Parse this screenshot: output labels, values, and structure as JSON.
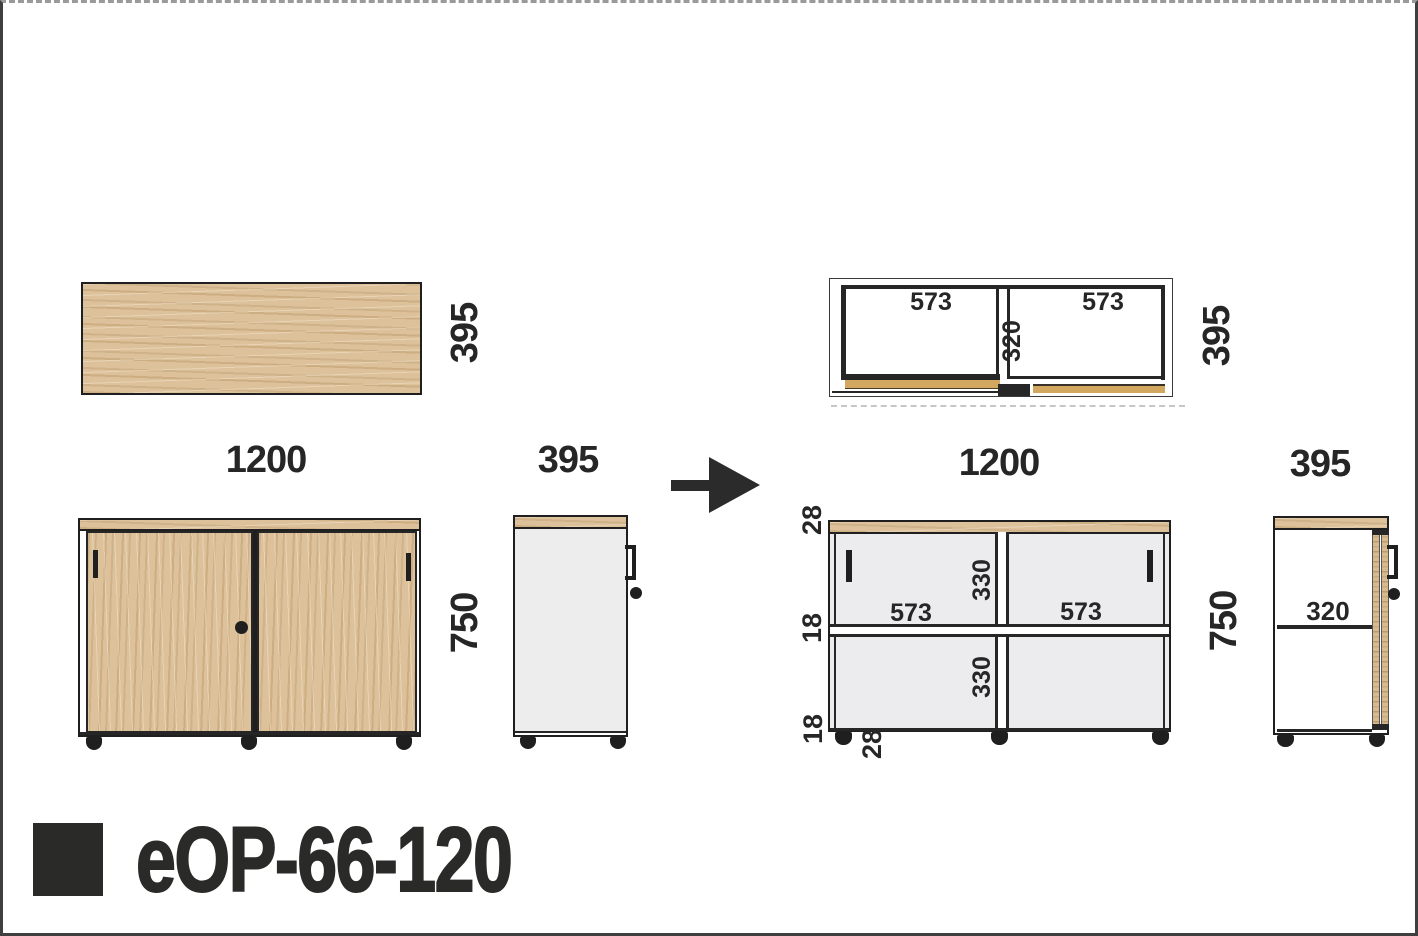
{
  "product": {
    "code": "eOP-66-120"
  },
  "labels": {
    "top_view_depth": "395",
    "top_view_width": "1200",
    "front_view_height": "750",
    "side_view_depth": "395",
    "plan_left_width": "573",
    "plan_right_width": "573",
    "plan_mid_depth": "320",
    "plan_depth": "395",
    "section_width": "1200",
    "section_top_thickness": "28",
    "section_shelf_thickness": "18",
    "section_bottom_thickness": "18",
    "section_plinth_height": "28",
    "section_left_width": "573",
    "section_right_width": "573",
    "section_upper_height": "330",
    "section_lower_height": "330",
    "section_height": "750",
    "side_section_depth": "395",
    "side_section_shelf_depth": "320"
  },
  "icons": {
    "arrow": "right-arrow"
  },
  "colors": {
    "wood": "#dcc19a",
    "door_gold": "#d2a75f",
    "line": "#1f1f1f",
    "panel_gray": "#ededee",
    "text": "#2a2a28"
  }
}
